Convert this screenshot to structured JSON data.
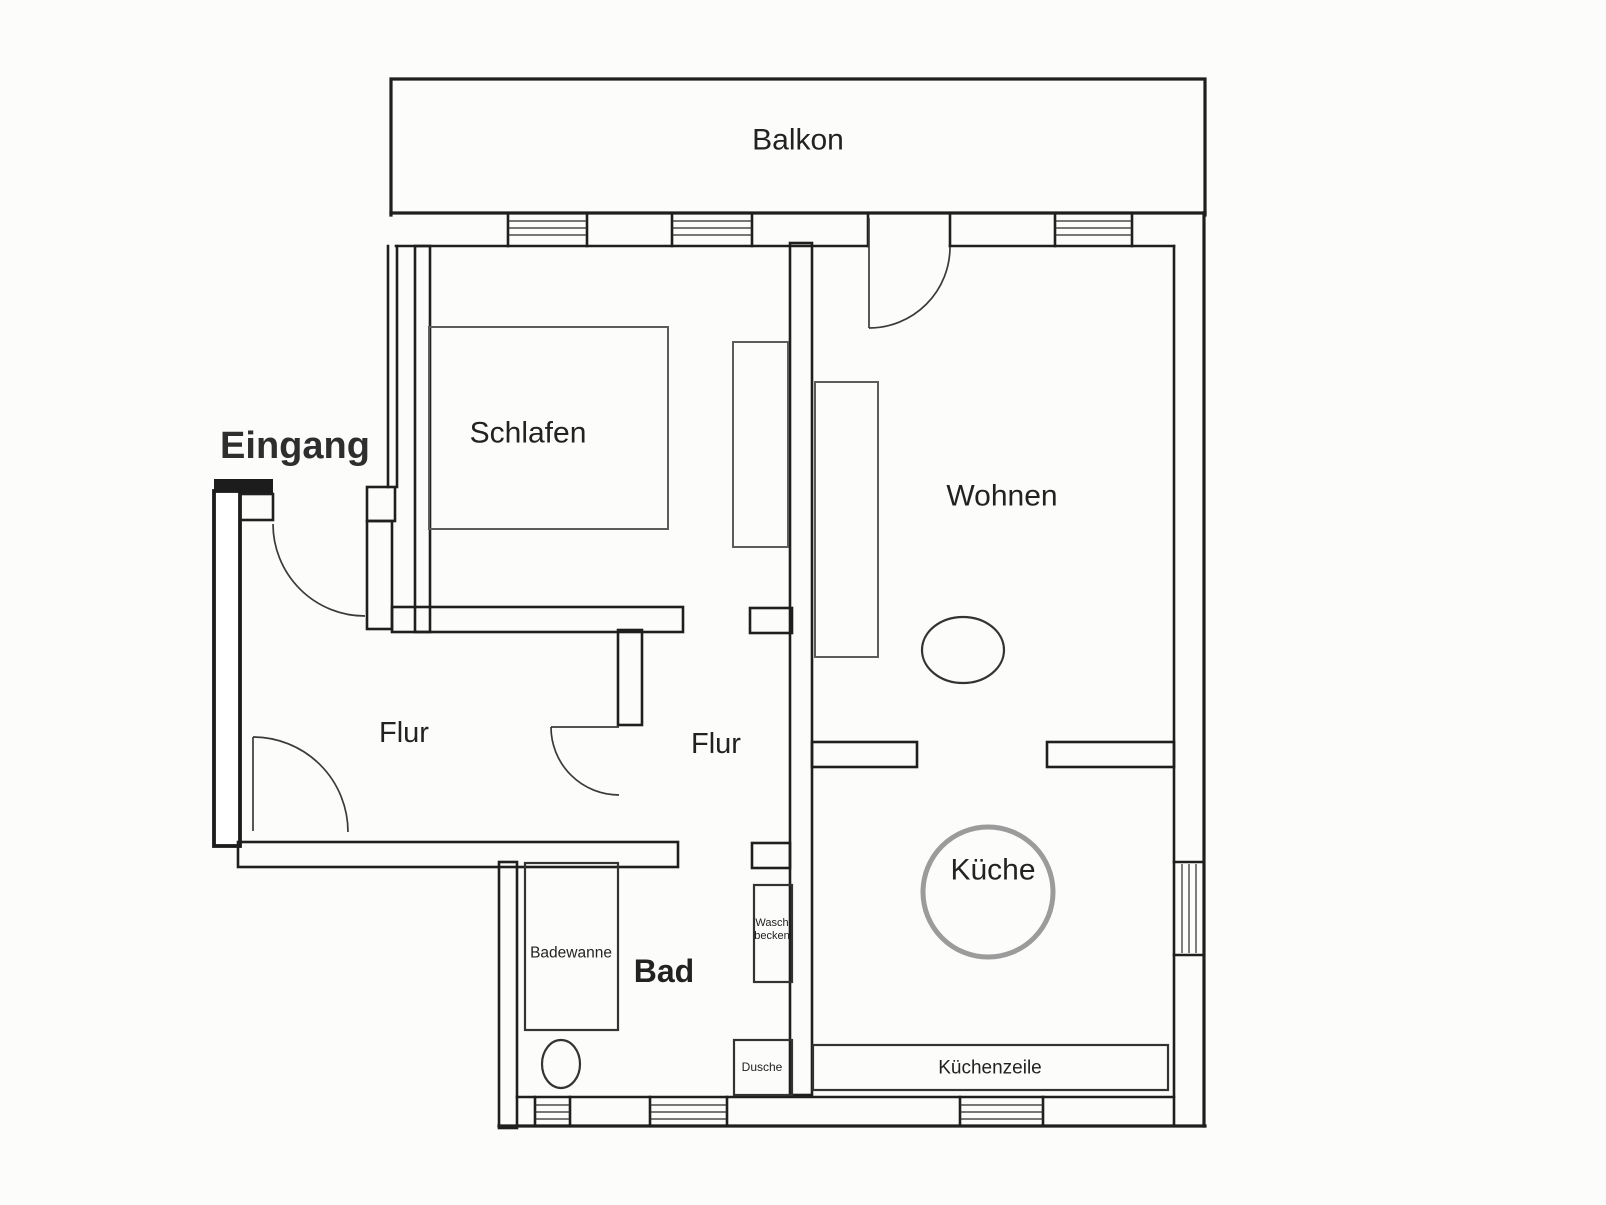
{
  "floorplan": {
    "rooms": {
      "balkon": {
        "label": "Balkon"
      },
      "eingang": {
        "label": "Eingang"
      },
      "schlafen": {
        "label": "Schlafen"
      },
      "wohnen": {
        "label": "Wohnen"
      },
      "flur_links": {
        "label": "Flur"
      },
      "flur_mitte": {
        "label": "Flur"
      },
      "bad": {
        "label": "Bad"
      },
      "kueche": {
        "label": "Küche"
      }
    },
    "fixtures": {
      "badewanne": {
        "label": "Badewanne"
      },
      "waschbecken": {
        "label_line1": "Wasch",
        "label_line2": "becken"
      },
      "dusche": {
        "label": "Dusche"
      },
      "kuechenzeile": {
        "label": "Küchenzeile"
      }
    },
    "colors": {
      "wall": "#1f1f1f",
      "furniture": "#5c5c5c",
      "kitchen_table_circle": "#9b9b9b",
      "text": "#222222",
      "background": "#fcfcfa"
    }
  }
}
